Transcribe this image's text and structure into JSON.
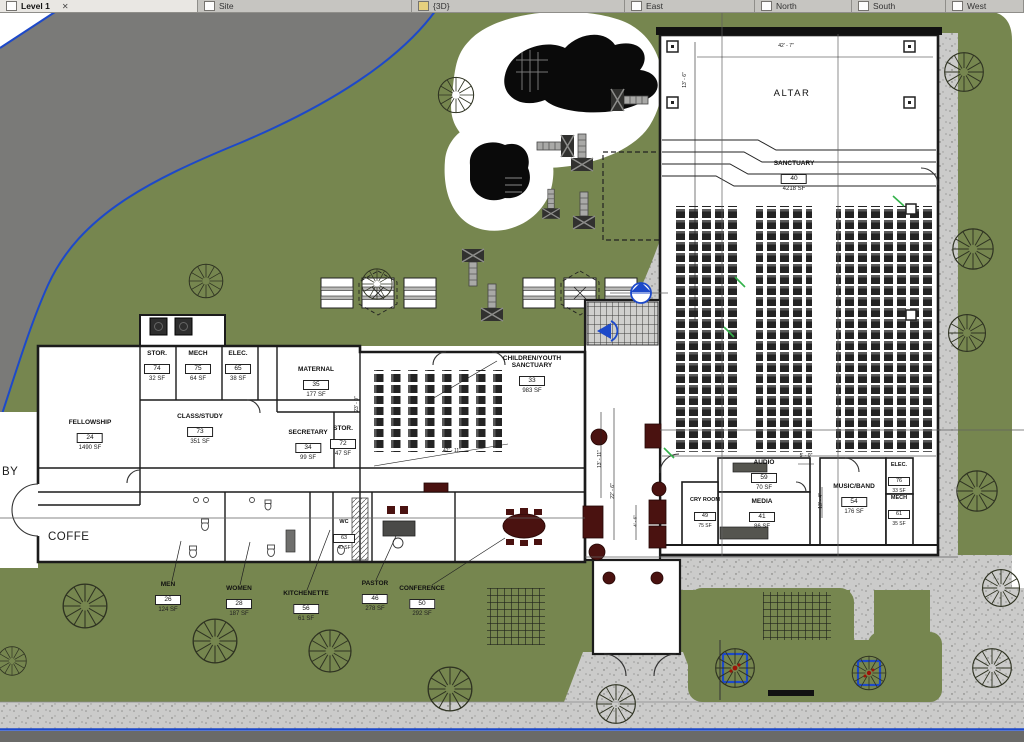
{
  "window": {
    "app": "Revit view tabs",
    "tabs": [
      {
        "label": "Level 1",
        "close_icon": "✕",
        "active": true
      },
      {
        "label": "Site"
      },
      {
        "label": "{3D}"
      },
      {
        "label": "East"
      },
      {
        "label": "North"
      },
      {
        "label": "South"
      },
      {
        "label": "West"
      }
    ]
  },
  "plan": {
    "texts": {
      "lobby_partial": "BY",
      "coffee": "COFFE"
    },
    "rooms": {
      "altar": {
        "name": "ALTAR"
      },
      "sanctuary": {
        "name": "SANCTUARY",
        "number": "40",
        "area": "4218 SF"
      },
      "children_youth": {
        "name": "CHILDREN/YOUTH SANCTUARY",
        "number": "33",
        "area": "983 SF"
      },
      "fellowship": {
        "name": "FELLOWSHIP",
        "number": "24",
        "area": "1490 SF"
      },
      "class_study": {
        "name": "CLASS/STUDY",
        "number": "73",
        "area": "351 SF"
      },
      "stor_a": {
        "name": "STOR.",
        "number": "74",
        "area": "32 SF"
      },
      "mech_a": {
        "name": "MECH",
        "number": "75",
        "area": "64 SF"
      },
      "elec_a": {
        "name": "ELEC.",
        "number": "65",
        "area": "38 SF"
      },
      "maternal": {
        "name": "MATERNAL",
        "number": "35",
        "area": "177 SF"
      },
      "secretary": {
        "name": "SECRETARY",
        "number": "34",
        "area": "99 SF"
      },
      "stor_b": {
        "name": "STOR.",
        "number": "72",
        "area": "47 SF"
      },
      "men": {
        "name": "MEN",
        "number": "26",
        "area": "124 SF"
      },
      "women": {
        "name": "WOMEN",
        "number": "28",
        "area": "187 SF"
      },
      "kitchenette": {
        "name": "KITCHENETTE",
        "number": "56",
        "area": "61 SF"
      },
      "pastor": {
        "name": "PASTOR",
        "number": "46",
        "area": "278 SF"
      },
      "conference": {
        "name": "CONFERENCE",
        "number": "50",
        "area": "292 SF"
      },
      "wc": {
        "name": "WC",
        "number": "63",
        "area": "40 SF"
      },
      "audio": {
        "name": "AUDIO",
        "number": "59",
        "area": "70 SF"
      },
      "media": {
        "name": "MEDIA",
        "number": "41",
        "area": "86 SF"
      },
      "cry_room": {
        "name": "CRY ROOM",
        "number": "49",
        "area": "75 SF"
      },
      "music_band": {
        "name": "MUSIC/BAND",
        "number": "54",
        "area": "176 SF"
      },
      "elec_b": {
        "name": "ELEC.",
        "number": "76",
        "area": "33 SF"
      },
      "mech_b": {
        "name": "MECH",
        "number": "61",
        "area": "35 SF"
      }
    },
    "dimensions": {
      "altar_width": "42' - 7\"",
      "altar_depth": "13' - 6\"",
      "audio_jog": "5' - 0\"",
      "band_depth": "13' - 4\"",
      "lobby_a": "13' - 11\"",
      "lobby_b": "22' - 6\"",
      "lobby_c": "4' - 6\"",
      "cys_width": "42' - 11\"",
      "cys_depth": "23' - 0\""
    },
    "colors": {
      "site_green": "#76864f",
      "paving": "#cbcbca",
      "road": "#6a6a68",
      "property_line": "#1d49c9",
      "wall": "#1b1b1b",
      "furniture": "#4a1210"
    }
  }
}
